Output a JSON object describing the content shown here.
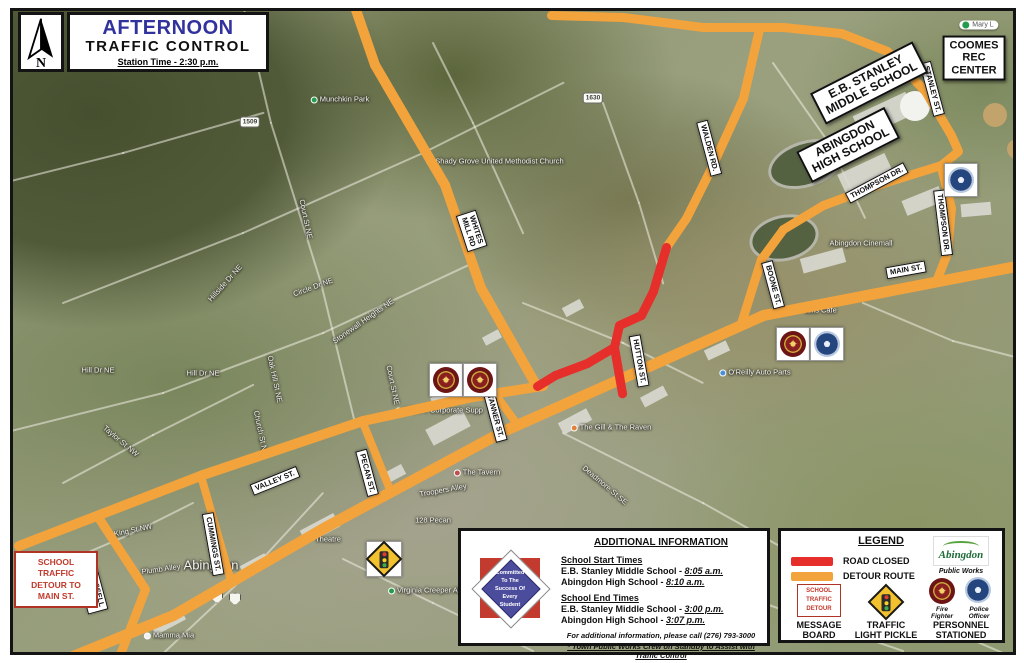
{
  "colors": {
    "detour_route": "#F2A33C",
    "road_closed": "#E62E2A",
    "title_blue": "#32329E",
    "sign_red": "#C0392B"
  },
  "header": {
    "north_label": "N",
    "title": "AFTERNOON",
    "subtitle": "TRAFFIC CONTROL",
    "station_time": "Station Time - 2:30 p.m."
  },
  "detour_sign": {
    "text": "SCHOOL\nTRAFFIC\nDETOUR TO\nMAIN ST."
  },
  "info_box": {
    "title": "ADDITIONAL INFORMATION",
    "logo_text": "Committed\nTo The\nSuccess Of\nEvery\nStudent",
    "start_header": "School Start Times",
    "start_items": [
      {
        "school": "E.B. Stanley Middle School - ",
        "time": "8:05 a.m."
      },
      {
        "school": "Abingdon High School - ",
        "time": "8:10 a.m."
      }
    ],
    "end_header": "School End Times",
    "end_items": [
      {
        "school": "E.B. Stanley Middle School - ",
        "time": "3:00 p.m."
      },
      {
        "school": "Abingdon High School - ",
        "time": "3:07 p.m."
      }
    ],
    "phone_note": "For additional information, please call (276) 793-3000",
    "standby_note": "* Town Public Works Crew on Standby to Assist with Traffic Control"
  },
  "legend": {
    "title": "LEGEND",
    "road_closed_label": "ROAD CLOSED",
    "detour_route_label": "DETOUR ROUTE",
    "message_board_sign": "SCHOOL\nTRAFFIC\nDETOUR",
    "message_board_label": "MESSAGE\nBOARD",
    "pickle_label": "TRAFFIC\nLIGHT PICKLE",
    "public_works_brand": "Abingdon",
    "public_works_label": "Public Works",
    "fire_label": "Fire\nFighter",
    "police_label": "Police\nOfficer",
    "personnel_label": "PERSONNEL\nSTATIONED"
  },
  "map": {
    "routes": {
      "detour": [
        {
          "w": 11,
          "pts": [
            [
              45,
              663
            ],
            [
              170,
              612
            ],
            [
              320,
              525
            ],
            [
              500,
              428
            ],
            [
              760,
              312
            ],
            [
              1018,
              262
            ]
          ]
        },
        {
          "w": 10,
          "pts": [
            [
              16,
              543
            ],
            [
              200,
              472
            ],
            [
              360,
              418
            ],
            [
              470,
              394
            ],
            [
              540,
              383
            ]
          ]
        },
        {
          "w": 9,
          "pts": [
            [
              95,
              514
            ],
            [
              142,
              586
            ],
            [
              112,
              664
            ]
          ]
        },
        {
          "w": 8,
          "pts": [
            [
              198,
              473
            ],
            [
              228,
              578
            ]
          ]
        },
        {
          "w": 8,
          "pts": [
            [
              360,
              420
            ],
            [
              388,
              489
            ]
          ]
        },
        {
          "w": 8,
          "pts": [
            [
              492,
              391
            ],
            [
              514,
              421
            ]
          ]
        },
        {
          "w": 10,
          "pts": [
            [
              352,
              4
            ],
            [
              372,
              62
            ],
            [
              442,
              182
            ],
            [
              478,
              285
            ],
            [
              532,
              380
            ]
          ]
        },
        {
          "w": 9,
          "pts": [
            [
              548,
              12
            ],
            [
              620,
              14
            ],
            [
              700,
              24
            ],
            [
              780,
              24
            ],
            [
              838,
              30
            ]
          ]
        },
        {
          "w": 9,
          "pts": [
            [
              838,
              30
            ],
            [
              884,
              48
            ],
            [
              922,
              88
            ],
            [
              948,
              132
            ]
          ]
        },
        {
          "w": 9,
          "pts": [
            [
              948,
              132
            ],
            [
              955,
              148
            ],
            [
              938,
              162
            ]
          ]
        },
        {
          "w": 9,
          "pts": [
            [
              938,
              162
            ],
            [
              880,
              180
            ],
            [
              820,
              202
            ],
            [
              780,
              226
            ],
            [
              758,
              256
            ],
            [
              738,
              320
            ]
          ]
        },
        {
          "w": 9,
          "pts": [
            [
              938,
              164
            ],
            [
              948,
              205
            ],
            [
              944,
              250
            ],
            [
              933,
              278
            ]
          ]
        },
        {
          "w": 9,
          "pts": [
            [
              756,
              26
            ],
            [
              740,
              95
            ],
            [
              708,
              165
            ],
            [
              683,
              215
            ],
            [
              663,
              244
            ]
          ]
        }
      ],
      "closed": [
        {
          "w": 9,
          "pts": [
            [
              663,
              244
            ],
            [
              650,
              288
            ],
            [
              638,
              312
            ],
            [
              616,
              322
            ],
            [
              611,
              344
            ],
            [
              584,
              360
            ],
            [
              552,
              372
            ],
            [
              534,
              383
            ]
          ]
        },
        {
          "w": 9,
          "pts": [
            [
              611,
              344
            ],
            [
              619,
              390
            ]
          ]
        }
      ]
    },
    "bg_roads": [
      [
        [
          240,
          2
        ],
        [
          268,
          120
        ],
        [
          318,
          280
        ],
        [
          352,
          420
        ]
      ],
      [
        [
          60,
          300
        ],
        [
          240,
          230
        ],
        [
          420,
          150
        ],
        [
          560,
          80
        ]
      ],
      [
        [
          0,
          430
        ],
        [
          160,
          390
        ],
        [
          320,
          330
        ],
        [
          470,
          260
        ]
      ],
      [
        [
          600,
          100
        ],
        [
          636,
          200
        ],
        [
          660,
          280
        ]
      ],
      [
        [
          770,
          60
        ],
        [
          826,
          140
        ],
        [
          862,
          215
        ]
      ],
      [
        [
          560,
          430
        ],
        [
          700,
          500
        ],
        [
          860,
          590
        ],
        [
          1000,
          650
        ]
      ],
      [
        [
          150,
          660
        ],
        [
          250,
          566
        ],
        [
          320,
          490
        ]
      ],
      [
        [
          60,
          480
        ],
        [
          150,
          432
        ],
        [
          250,
          382
        ]
      ],
      [
        [
          520,
          300
        ],
        [
          620,
          340
        ],
        [
          700,
          380
        ]
      ],
      [
        [
          860,
          300
        ],
        [
          950,
          338
        ],
        [
          1020,
          356
        ]
      ],
      [
        [
          340,
          556
        ],
        [
          430,
          600
        ],
        [
          530,
          648
        ]
      ],
      [
        [
          430,
          40
        ],
        [
          470,
          120
        ],
        [
          520,
          230
        ]
      ],
      [
        [
          0,
          180
        ],
        [
          120,
          150
        ],
        [
          260,
          110
        ]
      ],
      [
        [
          660,
          560
        ],
        [
          760,
          600
        ],
        [
          900,
          648
        ]
      ],
      [
        [
          60,
          560
        ],
        [
          130,
          530
        ],
        [
          190,
          500
        ]
      ]
    ],
    "buildings": [
      [
        852,
        100,
        58,
        24,
        -25
      ],
      [
        836,
        160,
        52,
        20,
        -25
      ],
      [
        900,
        190,
        40,
        16,
        -22
      ],
      [
        958,
        200,
        30,
        13,
        -5
      ],
      [
        798,
        250,
        44,
        15,
        -15
      ],
      [
        556,
        412,
        32,
        13,
        -28
      ],
      [
        428,
        388,
        28,
        11,
        -28
      ],
      [
        298,
        518,
        38,
        15,
        -28
      ],
      [
        238,
        556,
        28,
        13,
        -28
      ],
      [
        378,
        466,
        24,
        11,
        -28
      ],
      [
        638,
        388,
        26,
        11,
        -28
      ],
      [
        702,
        342,
        24,
        11,
        -25
      ],
      [
        148,
        612,
        34,
        13,
        -28
      ],
      [
        424,
        416,
        42,
        18,
        -28
      ],
      [
        560,
        300,
        20,
        10,
        -28
      ],
      [
        480,
        330,
        18,
        9,
        -28
      ]
    ],
    "fields": [
      [
        764,
        138,
        72,
        40,
        -18
      ],
      [
        746,
        212,
        64,
        40,
        -12
      ]
    ],
    "circles": [
      [
        912,
        103,
        15,
        "#f2f2ee"
      ],
      [
        992,
        112,
        12,
        "#c2a36b"
      ],
      [
        1014,
        146,
        10,
        "#c2a36b"
      ]
    ],
    "street_labels": [
      {
        "text": "WALDEN RD.",
        "x": 706,
        "y": 145,
        "rot": 75
      },
      {
        "text": "WHITES\nMILL RD",
        "x": 469,
        "y": 228,
        "rot": 72
      },
      {
        "text": "STANLEY ST.",
        "x": 929,
        "y": 86,
        "rot": 75
      },
      {
        "text": "THOMPSON DR.",
        "x": 874,
        "y": 180,
        "rot": -28
      },
      {
        "text": "THOMPSON DR.",
        "x": 940,
        "y": 220,
        "rot": 83
      },
      {
        "text": "MAIN ST.",
        "x": 903,
        "y": 267,
        "rot": -10
      },
      {
        "text": "BOONE ST.",
        "x": 770,
        "y": 282,
        "rot": 75
      },
      {
        "text": "HUTTON ST.",
        "x": 636,
        "y": 358,
        "rot": 80
      },
      {
        "text": "TANNER ST.",
        "x": 492,
        "y": 413,
        "rot": 75
      },
      {
        "text": "PECAN ST.",
        "x": 364,
        "y": 470,
        "rot": 75
      },
      {
        "text": "VALLEY ST.",
        "x": 272,
        "y": 478,
        "rot": -22
      },
      {
        "text": "CUMMINGS ST.",
        "x": 210,
        "y": 541,
        "rot": 80
      },
      {
        "text": "RUSSELL\nRD",
        "x": 90,
        "y": 588,
        "rot": 75
      }
    ],
    "place_boxes": [
      {
        "text": "COOMES\nREC\nCENTER",
        "x": 971,
        "y": 55,
        "rot": 0,
        "size": 11
      },
      {
        "text": "E.B. STANLEY\nMIDDLE SCHOOL",
        "x": 866,
        "y": 80,
        "rot": -27,
        "size": 12
      },
      {
        "text": "ABINGDON\nHIGH SCHOOL",
        "x": 845,
        "y": 142,
        "rot": -27,
        "size": 12
      }
    ],
    "g_labels": [
      {
        "text": "Munchkin Park",
        "x": 337,
        "y": 96,
        "marker": "#259b4e"
      },
      {
        "text": "Shady Grove United Methodist Church",
        "x": 492,
        "y": 158,
        "marker": "#8a8a8a"
      },
      {
        "text": "Abingdon Cinemall",
        "x": 858,
        "y": 240
      },
      {
        "text": "O'Reilly Auto Parts",
        "x": 752,
        "y": 369,
        "marker": "#4a90d9"
      },
      {
        "text": "Ellis Cafe",
        "x": 818,
        "y": 307
      },
      {
        "text": "The Gill & The Raven",
        "x": 608,
        "y": 424,
        "marker": "#e0823c"
      },
      {
        "text": "The Tavern",
        "x": 474,
        "y": 469,
        "marker": "#c0504d"
      },
      {
        "text": "Troopers Alley",
        "x": 440,
        "y": 487,
        "rot": -10
      },
      {
        "text": "128 Pecan",
        "x": 430,
        "y": 517
      },
      {
        "text": "Theatre",
        "x": 325,
        "y": 536
      },
      {
        "text": "Virginia Creeper Ab",
        "x": 422,
        "y": 587,
        "marker": "#259b4e"
      },
      {
        "text": "Mamma Mia",
        "x": 166,
        "y": 632,
        "marker": "#f2f2f2"
      },
      {
        "text": "K-VA-T Corporate Supp",
        "x": 436,
        "y": 407,
        "marker": "#4a90d9"
      },
      {
        "text": "Abingdon",
        "x": 208,
        "y": 562,
        "size": 13
      },
      {
        "text": "Hill Dr NE",
        "x": 95,
        "y": 367
      },
      {
        "text": "Hill Dr NE",
        "x": 200,
        "y": 370
      },
      {
        "text": "Stonewall Heights NE",
        "x": 360,
        "y": 318,
        "rot": -35
      },
      {
        "text": "Hillside Dr NE",
        "x": 222,
        "y": 280,
        "rot": -48
      },
      {
        "text": "Circle Dr NE",
        "x": 310,
        "y": 284,
        "rot": -20
      },
      {
        "text": "Oak Hill St NE",
        "x": 272,
        "y": 376,
        "rot": 78
      },
      {
        "text": "Church St NE",
        "x": 258,
        "y": 430,
        "rot": 78
      },
      {
        "text": "Court St NE",
        "x": 303,
        "y": 216,
        "rot": 78
      },
      {
        "text": "Court St NE",
        "x": 390,
        "y": 382,
        "rot": 78
      },
      {
        "text": "King St NW",
        "x": 130,
        "y": 527,
        "rot": -12
      },
      {
        "text": "Plumb Alley",
        "x": 158,
        "y": 566,
        "rot": -8
      },
      {
        "text": "Taylor St NW",
        "x": 118,
        "y": 438,
        "rot": 40
      },
      {
        "text": "Deadmore St SE",
        "x": 602,
        "y": 482,
        "rot": 40
      }
    ],
    "shields": [
      {
        "text": "1509",
        "x": 247,
        "y": 119
      },
      {
        "text": "1630",
        "x": 590,
        "y": 95
      }
    ],
    "us_shields": [
      {
        "x": 214,
        "y": 594
      },
      {
        "x": 232,
        "y": 596
      }
    ],
    "icons": [
      {
        "t": "fire",
        "x": 443,
        "y": 377
      },
      {
        "t": "fire",
        "x": 477,
        "y": 377
      },
      {
        "t": "fire",
        "x": 790,
        "y": 341
      },
      {
        "t": "police",
        "x": 824,
        "y": 341
      },
      {
        "t": "police",
        "x": 958,
        "y": 177
      },
      {
        "t": "pickle",
        "x": 381,
        "y": 556
      },
      {
        "t": "chip",
        "x": 976,
        "y": 22,
        "text": "Mary L"
      }
    ]
  }
}
